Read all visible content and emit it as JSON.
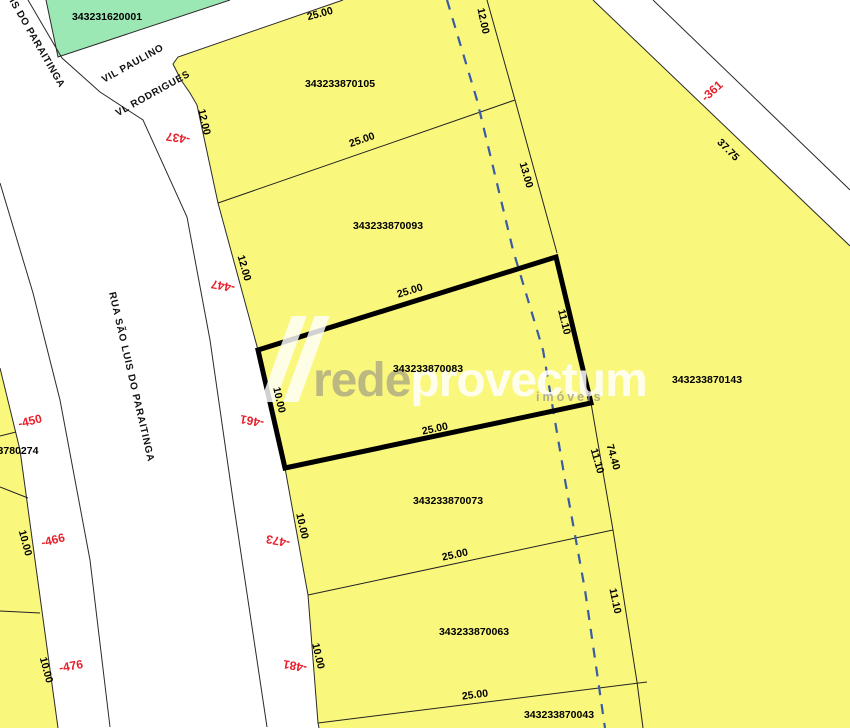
{
  "map": {
    "colors": {
      "parcel_yellow": "#FAF77D",
      "parcel_green": "#9CE8B4",
      "highlight_border": "#000000",
      "address_red": "#E8202C",
      "dashed_line_blue": "#3A5BA8"
    },
    "parcels": {
      "green": "343231620001",
      "p105": "343233870105",
      "p093": "343233870093",
      "p083": "343233870083",
      "p143": "343233870143",
      "p073": "343233870073",
      "p063": "343233870063",
      "p043": "343233870043",
      "west_partial": "3780274"
    },
    "streets": {
      "vil_paulino": "VIL PAULINO",
      "vl_rodrigues": "VL RODRIGUES",
      "rua_sao_luis": "RUA SÃO LUIS DO PARAITINGA",
      "rua_sao_luis_top": "LUIS DO PARAITINGA"
    },
    "dimensions": [
      {
        "v": "25.00"
      },
      {
        "v": "12.00"
      },
      {
        "v": "12.00"
      },
      {
        "v": "25.00"
      },
      {
        "v": "13.00"
      },
      {
        "v": "12.00"
      },
      {
        "v": "25.00"
      },
      {
        "v": "11.10"
      },
      {
        "v": "10.00"
      },
      {
        "v": "25.00"
      },
      {
        "v": "11.10"
      },
      {
        "v": "74.40"
      },
      {
        "v": "10.00"
      },
      {
        "v": "25.00"
      },
      {
        "v": "10.00"
      },
      {
        "v": "25.00"
      },
      {
        "v": "11.10"
      },
      {
        "v": "10.00"
      },
      {
        "v": "10.00"
      },
      {
        "v": "37.75"
      }
    ],
    "addresses": [
      {
        "v": "-437"
      },
      {
        "v": "-447"
      },
      {
        "v": "-461"
      },
      {
        "v": "-473"
      },
      {
        "v": "-481"
      },
      {
        "v": "-450"
      },
      {
        "v": "-466"
      },
      {
        "v": "-476"
      },
      {
        "v": "-361"
      }
    ],
    "watermark": {
      "brand": "rede",
      "brand2": "provectum",
      "tagline": "imóveis"
    }
  }
}
